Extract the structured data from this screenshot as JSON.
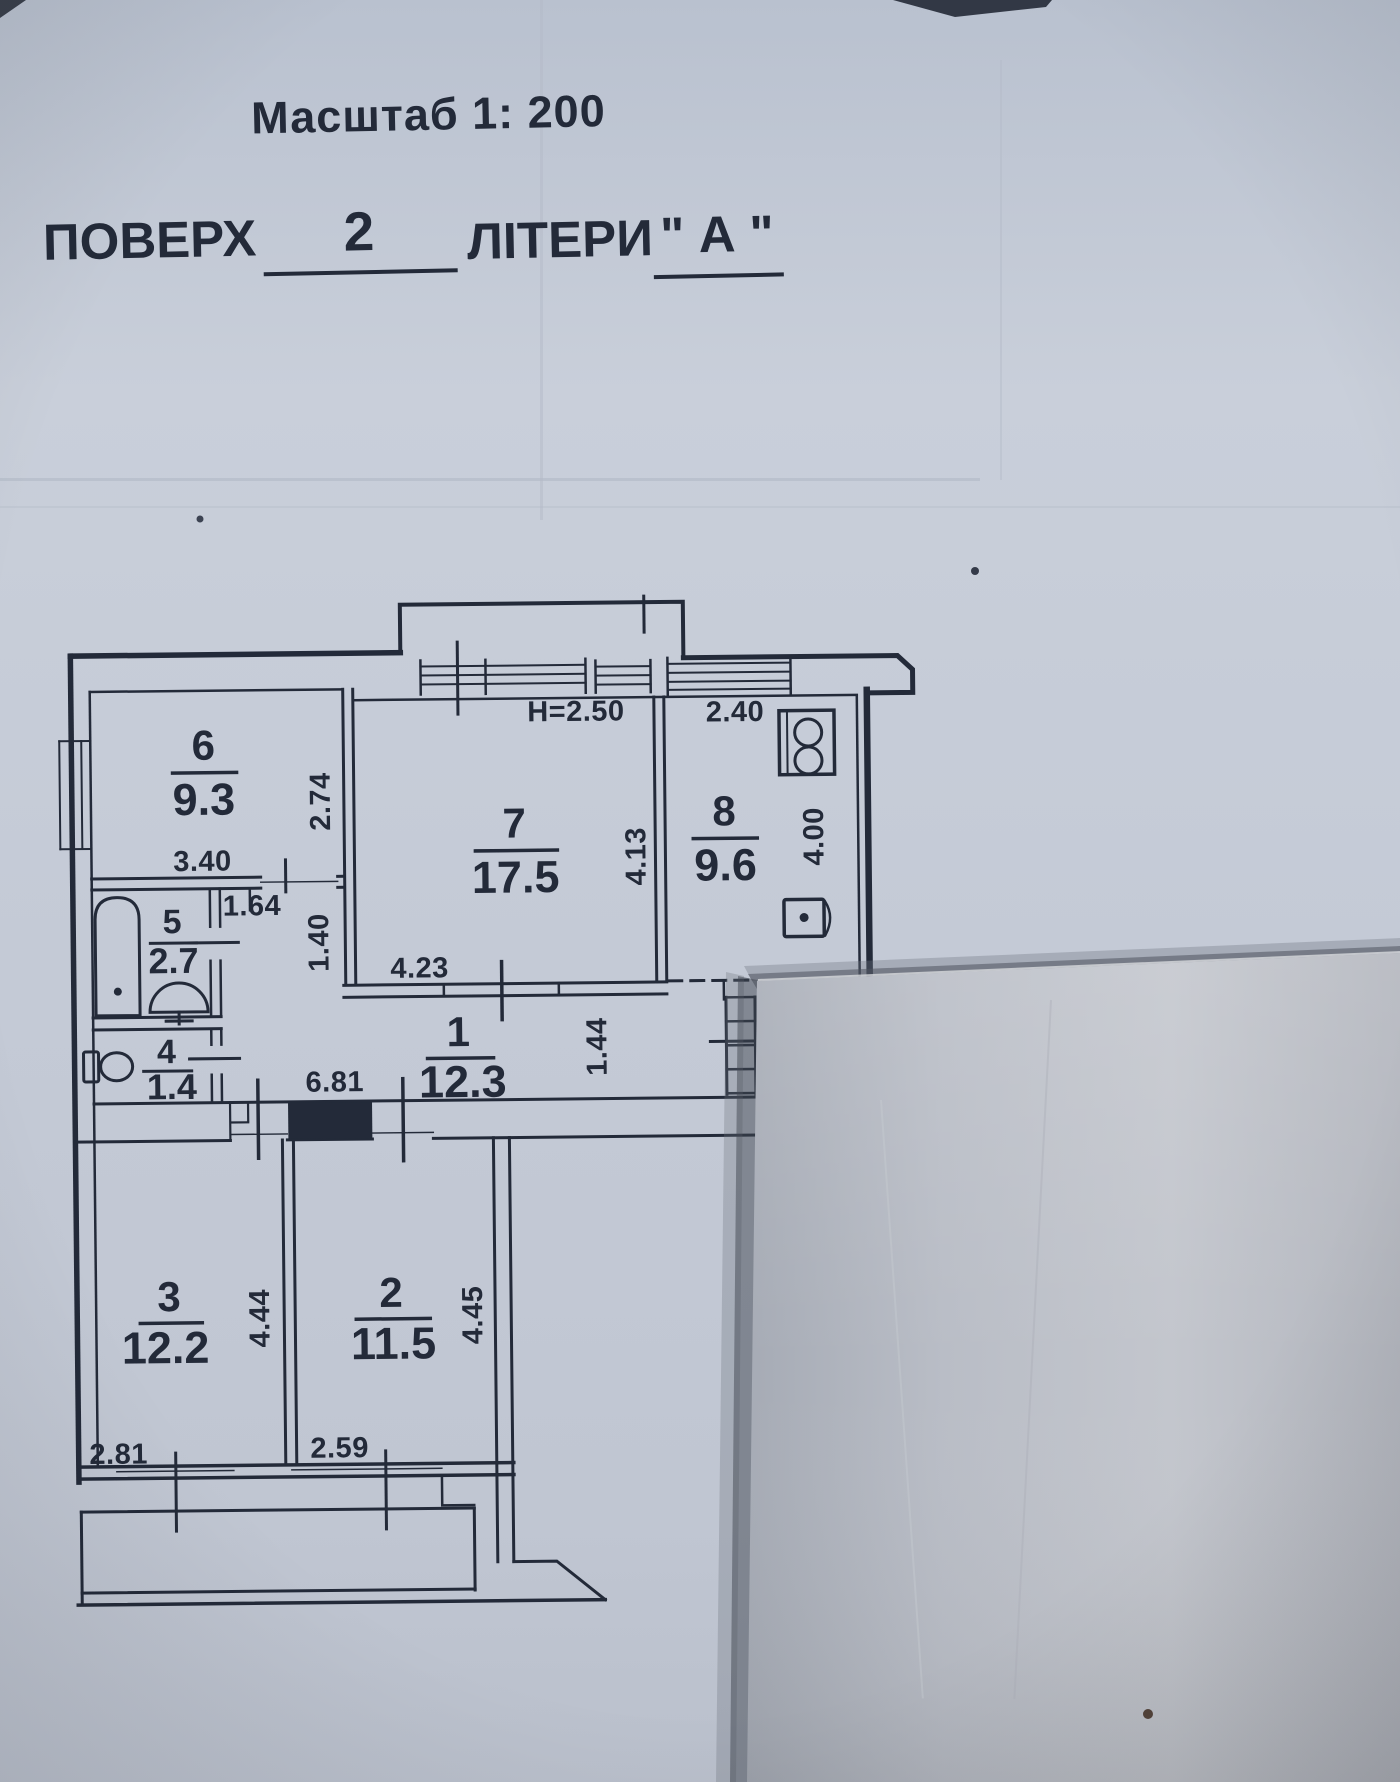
{
  "header": {
    "scale": "Масштаб 1: 200",
    "floor_label": "ПОВЕРХ",
    "floor_value": "2",
    "letters_label": "ЛІТЕРИ",
    "letters_value": "\" А \""
  },
  "rooms": {
    "r1": {
      "number": "1",
      "area": "12.3"
    },
    "r2": {
      "number": "2",
      "area": "11.5"
    },
    "r3": {
      "number": "3",
      "area": "12.2"
    },
    "r4": {
      "number": "4",
      "area": "1.4"
    },
    "r5": {
      "number": "5",
      "area": "2.7"
    },
    "r6": {
      "number": "6",
      "area": "9.3"
    },
    "r7": {
      "number": "7",
      "area": "17.5"
    },
    "r8": {
      "number": "8",
      "area": "9.6"
    }
  },
  "dims": {
    "ceiling_height": "H=2.50",
    "kitchen_top": "2.40",
    "kitchen_right": "4.00",
    "room7_right": "4.13",
    "room7_bottom": "4.23",
    "room6_right": "2.74",
    "room6_bottom": "3.40",
    "niche": "1.64",
    "niche_height": "1.40",
    "corridor": "6.81",
    "corridor_height": "1.44",
    "room3_right": "4.44",
    "room2_right": "4.45",
    "room3_window": "2.81",
    "room2_window": "2.59"
  },
  "icons": {
    "fixtures": [
      "bathtub-icon",
      "wash-basin-icon",
      "toilet-icon",
      "stove-icon",
      "kitchen-sink-icon"
    ]
  },
  "colors": {
    "paper": "#c6ccd8",
    "paper_overlay": "#b7bbc4",
    "ink": "#232a39",
    "shadow": "#4e545e"
  }
}
